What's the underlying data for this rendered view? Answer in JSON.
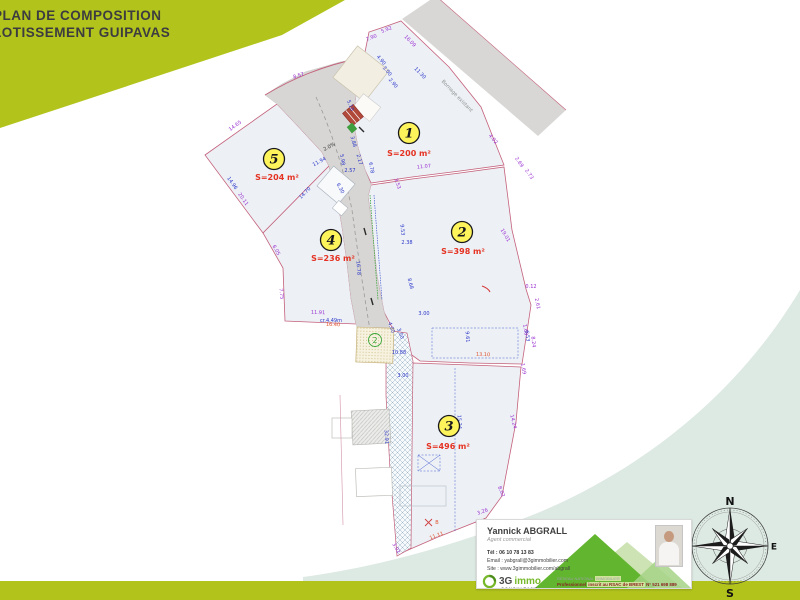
{
  "header": {
    "line1": "PLAN DE COMPOSITION",
    "line2": "LOTISSEMENT GUIPAVAS"
  },
  "plan": {
    "lots": [
      {
        "id": "1",
        "area": "S=200 m²",
        "bx": 409,
        "by": 133,
        "lx": 409,
        "ly": 156
      },
      {
        "id": "2",
        "area": "S=398 m²",
        "bx": 462,
        "by": 232,
        "lx": 463,
        "ly": 254
      },
      {
        "id": "3",
        "area": "S=496 m²",
        "bx": 449,
        "by": 426,
        "lx": 448,
        "ly": 449
      },
      {
        "id": "4",
        "area": "S=236 m²",
        "bx": 331,
        "by": 240,
        "lx": 333,
        "ly": 261
      },
      {
        "id": "5",
        "area": "S=204 m²",
        "bx": 274,
        "by": 159,
        "lx": 277,
        "ly": 180
      }
    ],
    "sub_badge": "2",
    "dimensions": [
      {
        "t": "8.57",
        "x": 299,
        "y": 77,
        "r": -17,
        "c": "p"
      },
      {
        "t": "7.90",
        "x": 372,
        "y": 39,
        "r": -22,
        "c": "p"
      },
      {
        "t": "5.92",
        "x": 387,
        "y": 31,
        "r": -22,
        "c": "p"
      },
      {
        "t": "16.09",
        "x": 409,
        "y": 42,
        "r": 46,
        "c": "p"
      },
      {
        "t": "11.30",
        "x": 419,
        "y": 74,
        "r": 46,
        "c": "b"
      },
      {
        "t": "Bornage existant",
        "x": 456,
        "y": 97,
        "r": 46,
        "c": "g",
        "s": 5.5
      },
      {
        "t": "4.02",
        "x": 492,
        "y": 140,
        "r": 50,
        "c": "p"
      },
      {
        "t": "2.69",
        "x": 518,
        "y": 163,
        "r": 55,
        "c": "p"
      },
      {
        "t": "2.73",
        "x": 528,
        "y": 175,
        "r": 55,
        "c": "p"
      },
      {
        "t": "11.07",
        "x": 424,
        "y": 168,
        "r": -6,
        "c": "p"
      },
      {
        "t": "4.90",
        "x": 380,
        "y": 61,
        "r": 50,
        "c": "b"
      },
      {
        "t": "3.00",
        "x": 386,
        "y": 72,
        "r": 50,
        "c": "b"
      },
      {
        "t": "2.90",
        "x": 392,
        "y": 84,
        "r": 50,
        "c": "b"
      },
      {
        "t": "5.10",
        "x": 349,
        "y": 106,
        "r": 68,
        "c": "b"
      },
      {
        "t": "3.88",
        "x": 352,
        "y": 142,
        "r": 75,
        "c": "b"
      },
      {
        "t": "2.17",
        "x": 358,
        "y": 160,
        "r": 75,
        "c": "b"
      },
      {
        "t": "2.57",
        "x": 350,
        "y": 172,
        "r": 0,
        "c": "b"
      },
      {
        "t": "6.78",
        "x": 370,
        "y": 168,
        "r": 80,
        "c": "b"
      },
      {
        "t": "5.98",
        "x": 341,
        "y": 160,
        "r": 80,
        "c": "b"
      },
      {
        "t": "2.0%",
        "x": 330,
        "y": 148,
        "r": -28,
        "c": "k"
      },
      {
        "t": "11.94",
        "x": 320,
        "y": 163,
        "r": -28,
        "c": "b"
      },
      {
        "t": "14.65",
        "x": 236,
        "y": 127,
        "r": -36,
        "c": "p"
      },
      {
        "t": "14.96",
        "x": 231,
        "y": 184,
        "r": 55,
        "c": "b"
      },
      {
        "t": "20.11",
        "x": 242,
        "y": 200,
        "r": 55,
        "c": "p"
      },
      {
        "t": "6.05",
        "x": 275,
        "y": 251,
        "r": 60,
        "c": "p"
      },
      {
        "t": "7.75",
        "x": 280,
        "y": 294,
        "r": 84,
        "c": "p"
      },
      {
        "t": "14.70",
        "x": 306,
        "y": 194,
        "r": -46,
        "c": "b"
      },
      {
        "t": "6.30",
        "x": 339,
        "y": 189,
        "r": 62,
        "c": "b"
      },
      {
        "t": "16.78",
        "x": 357,
        "y": 268,
        "r": 86,
        "c": "b"
      },
      {
        "t": "11.91",
        "x": 318,
        "y": 314,
        "r": 2,
        "c": "p"
      },
      {
        "t": "16.40",
        "x": 333,
        "y": 326,
        "r": 2,
        "c": "r"
      },
      {
        "t": "3.53",
        "x": 396,
        "y": 184,
        "r": 72,
        "c": "p"
      },
      {
        "t": "9.53",
        "x": 401,
        "y": 230,
        "r": 84,
        "c": "b"
      },
      {
        "t": "2.38",
        "x": 407,
        "y": 244,
        "r": 0,
        "c": "b"
      },
      {
        "t": "8.68",
        "x": 409,
        "y": 284,
        "r": 76,
        "c": "b"
      },
      {
        "t": "4.00",
        "x": 390,
        "y": 328,
        "r": 70,
        "c": "b"
      },
      {
        "t": "3.00",
        "x": 399,
        "y": 334,
        "r": 70,
        "c": "b"
      },
      {
        "t": "3.00",
        "x": 424,
        "y": 315,
        "r": 0,
        "c": "b"
      },
      {
        "t": "cr.4.49m",
        "x": 331,
        "y": 322,
        "r": 0,
        "c": "b"
      },
      {
        "t": "10.88",
        "x": 399,
        "y": 354,
        "r": 0,
        "c": "b"
      },
      {
        "t": "3.00",
        "x": 403,
        "y": 377,
        "r": 0,
        "c": "b"
      },
      {
        "t": "9.61",
        "x": 466,
        "y": 337,
        "r": 86,
        "c": "b"
      },
      {
        "t": "13.10",
        "x": 483,
        "y": 356,
        "r": 2,
        "c": "r"
      },
      {
        "t": "1.68",
        "x": 524,
        "y": 330,
        "r": 80,
        "c": "p"
      },
      {
        "t": "19.01",
        "x": 504,
        "y": 236,
        "r": 60,
        "c": "p"
      },
      {
        "t": "0.12",
        "x": 531,
        "y": 288,
        "r": 0,
        "c": "p"
      },
      {
        "t": "2.61",
        "x": 536,
        "y": 304,
        "r": 78,
        "c": "p"
      },
      {
        "t": "6.53",
        "x": 526,
        "y": 336,
        "r": 84,
        "c": "b"
      },
      {
        "t": "8.24",
        "x": 532,
        "y": 342,
        "r": 84,
        "c": "p"
      },
      {
        "t": "1.69",
        "x": 522,
        "y": 369,
        "r": 80,
        "c": "p"
      },
      {
        "t": "14.24",
        "x": 512,
        "y": 422,
        "r": 76,
        "c": "p"
      },
      {
        "t": "15.24",
        "x": 458,
        "y": 422,
        "r": 87,
        "c": "b"
      },
      {
        "t": "8.02",
        "x": 500,
        "y": 492,
        "r": 68,
        "c": "p"
      },
      {
        "t": "3.26",
        "x": 483,
        "y": 513,
        "r": -20,
        "c": "p"
      },
      {
        "t": "11.11",
        "x": 437,
        "y": 537,
        "r": -21,
        "c": "r"
      },
      {
        "t": "32.91",
        "x": 385,
        "y": 437,
        "r": 87,
        "c": "b"
      },
      {
        "t": "3.02",
        "x": 395,
        "y": 549,
        "r": 60,
        "c": "p"
      },
      {
        "t": "B",
        "x": 437,
        "y": 524,
        "r": 0,
        "c": "r"
      }
    ]
  },
  "compass": {
    "n": "N",
    "s": "S",
    "e": "E",
    "w": "O"
  },
  "contact": {
    "name": "Yannick ABGRALL",
    "role": "Agent commercial",
    "phone_label": "Tél :",
    "phone": "06 10 78 13 83",
    "email_label": "Email :",
    "email": "yabgrall@3gimmobilier.com",
    "site_label": "Site :",
    "site": "www.3gimmobilier.com/abgrall",
    "brand_3g": "3G",
    "brand_immo": "immo",
    "brand_sub": "CONSULTANT",
    "network_a": "RÉSEAU NATIONAL",
    "network_b": "IMMOBILIER",
    "legal_a": "Professionnel",
    "legal_b": "inscrit au RSAC de BREST",
    "legal_c": "N° 521 698 889"
  },
  "colors": {
    "lime": "#b2c41c",
    "teal": "#dde9e3",
    "parcel_border": "#c4607a",
    "area_red": "#e53222",
    "dim_purple": "#992fd0",
    "dim_blue": "#2a35c8",
    "badge_yellow": "#fdf35a",
    "road_gray": "#d7d6d4",
    "brand_green": "#76b82a"
  }
}
